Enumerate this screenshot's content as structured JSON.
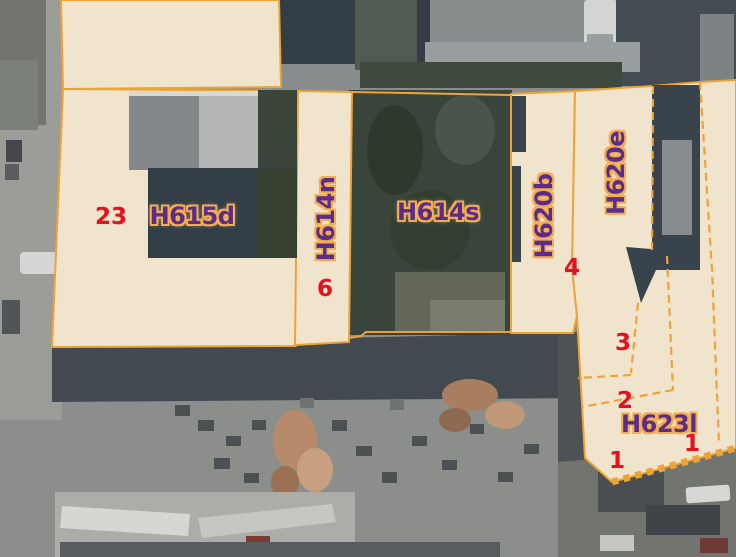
{
  "map": {
    "parcels": [
      {
        "label": "H615d"
      },
      {
        "label": "H614n"
      },
      {
        "label": "H614s"
      },
      {
        "label": "H620b"
      },
      {
        "label": "H620e"
      },
      {
        "label": "H623l"
      }
    ],
    "house_numbers": [
      "23",
      "6",
      "4",
      "3",
      "2",
      "1",
      "1"
    ],
    "colors": {
      "parcel_fill": "#f1e4cc",
      "parcel_border": "#eda338",
      "label_text": "#5b2c8c",
      "label_halo": "#f2ae50",
      "number_text": "#e21220"
    }
  }
}
